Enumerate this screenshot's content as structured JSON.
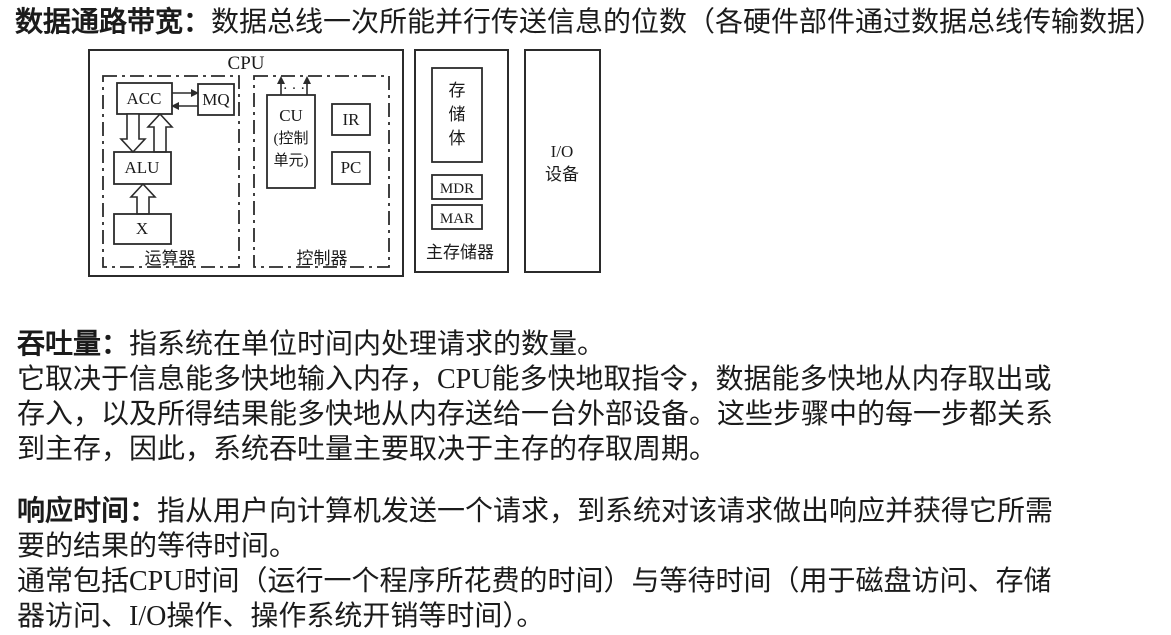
{
  "title": {
    "term": "数据通路带宽：",
    "definition": "数据总线一次所能并行传送信息的位数（各硬件部件通过数据总线传输数据）"
  },
  "diagram": {
    "cpu_label": "CPU",
    "alu_section": {
      "label": "运算器",
      "acc": "ACC",
      "mq": "MQ",
      "alu": "ALU",
      "x": "X"
    },
    "cu_section": {
      "label": "控制器",
      "cu_line1": "CU",
      "cu_line2": "(控制",
      "cu_line3": "单元)",
      "dots": "· · ·",
      "ir": "IR",
      "pc": "PC"
    },
    "memory": {
      "label": "主存储器",
      "bank_char1": "存",
      "bank_char2": "储",
      "bank_char3": "体",
      "mdr": "MDR",
      "mar": "MAR"
    },
    "io": {
      "line1": "I/O",
      "line2": "设备"
    },
    "stroke_color": "#2b2b2b"
  },
  "throughput": {
    "term": "吞吐量：",
    "intro": "指系统在单位时间内处理请求的数量。",
    "lines": [
      "它取决于信息能多快地输入内存，CPU能多快地取指令，数据能多快地从内存取出或",
      "存入，以及所得结果能多快地从内存送给一台外部设备。这些步骤中的每一步都关系",
      "到主存，因此，系统吞吐量主要取决于主存的存取周期。"
    ]
  },
  "response_time": {
    "term": "响应时间：",
    "intro": "指从用户向计算机发送一个请求，到系统对该请求做出响应并获得它所需",
    "lines": [
      "要的结果的等待时间。",
      "通常包括CPU时间（运行一个程序所花费的时间）与等待时间（用于磁盘访问、存储",
      "器访问、I/O操作、操作系统开销等时间）。"
    ]
  }
}
